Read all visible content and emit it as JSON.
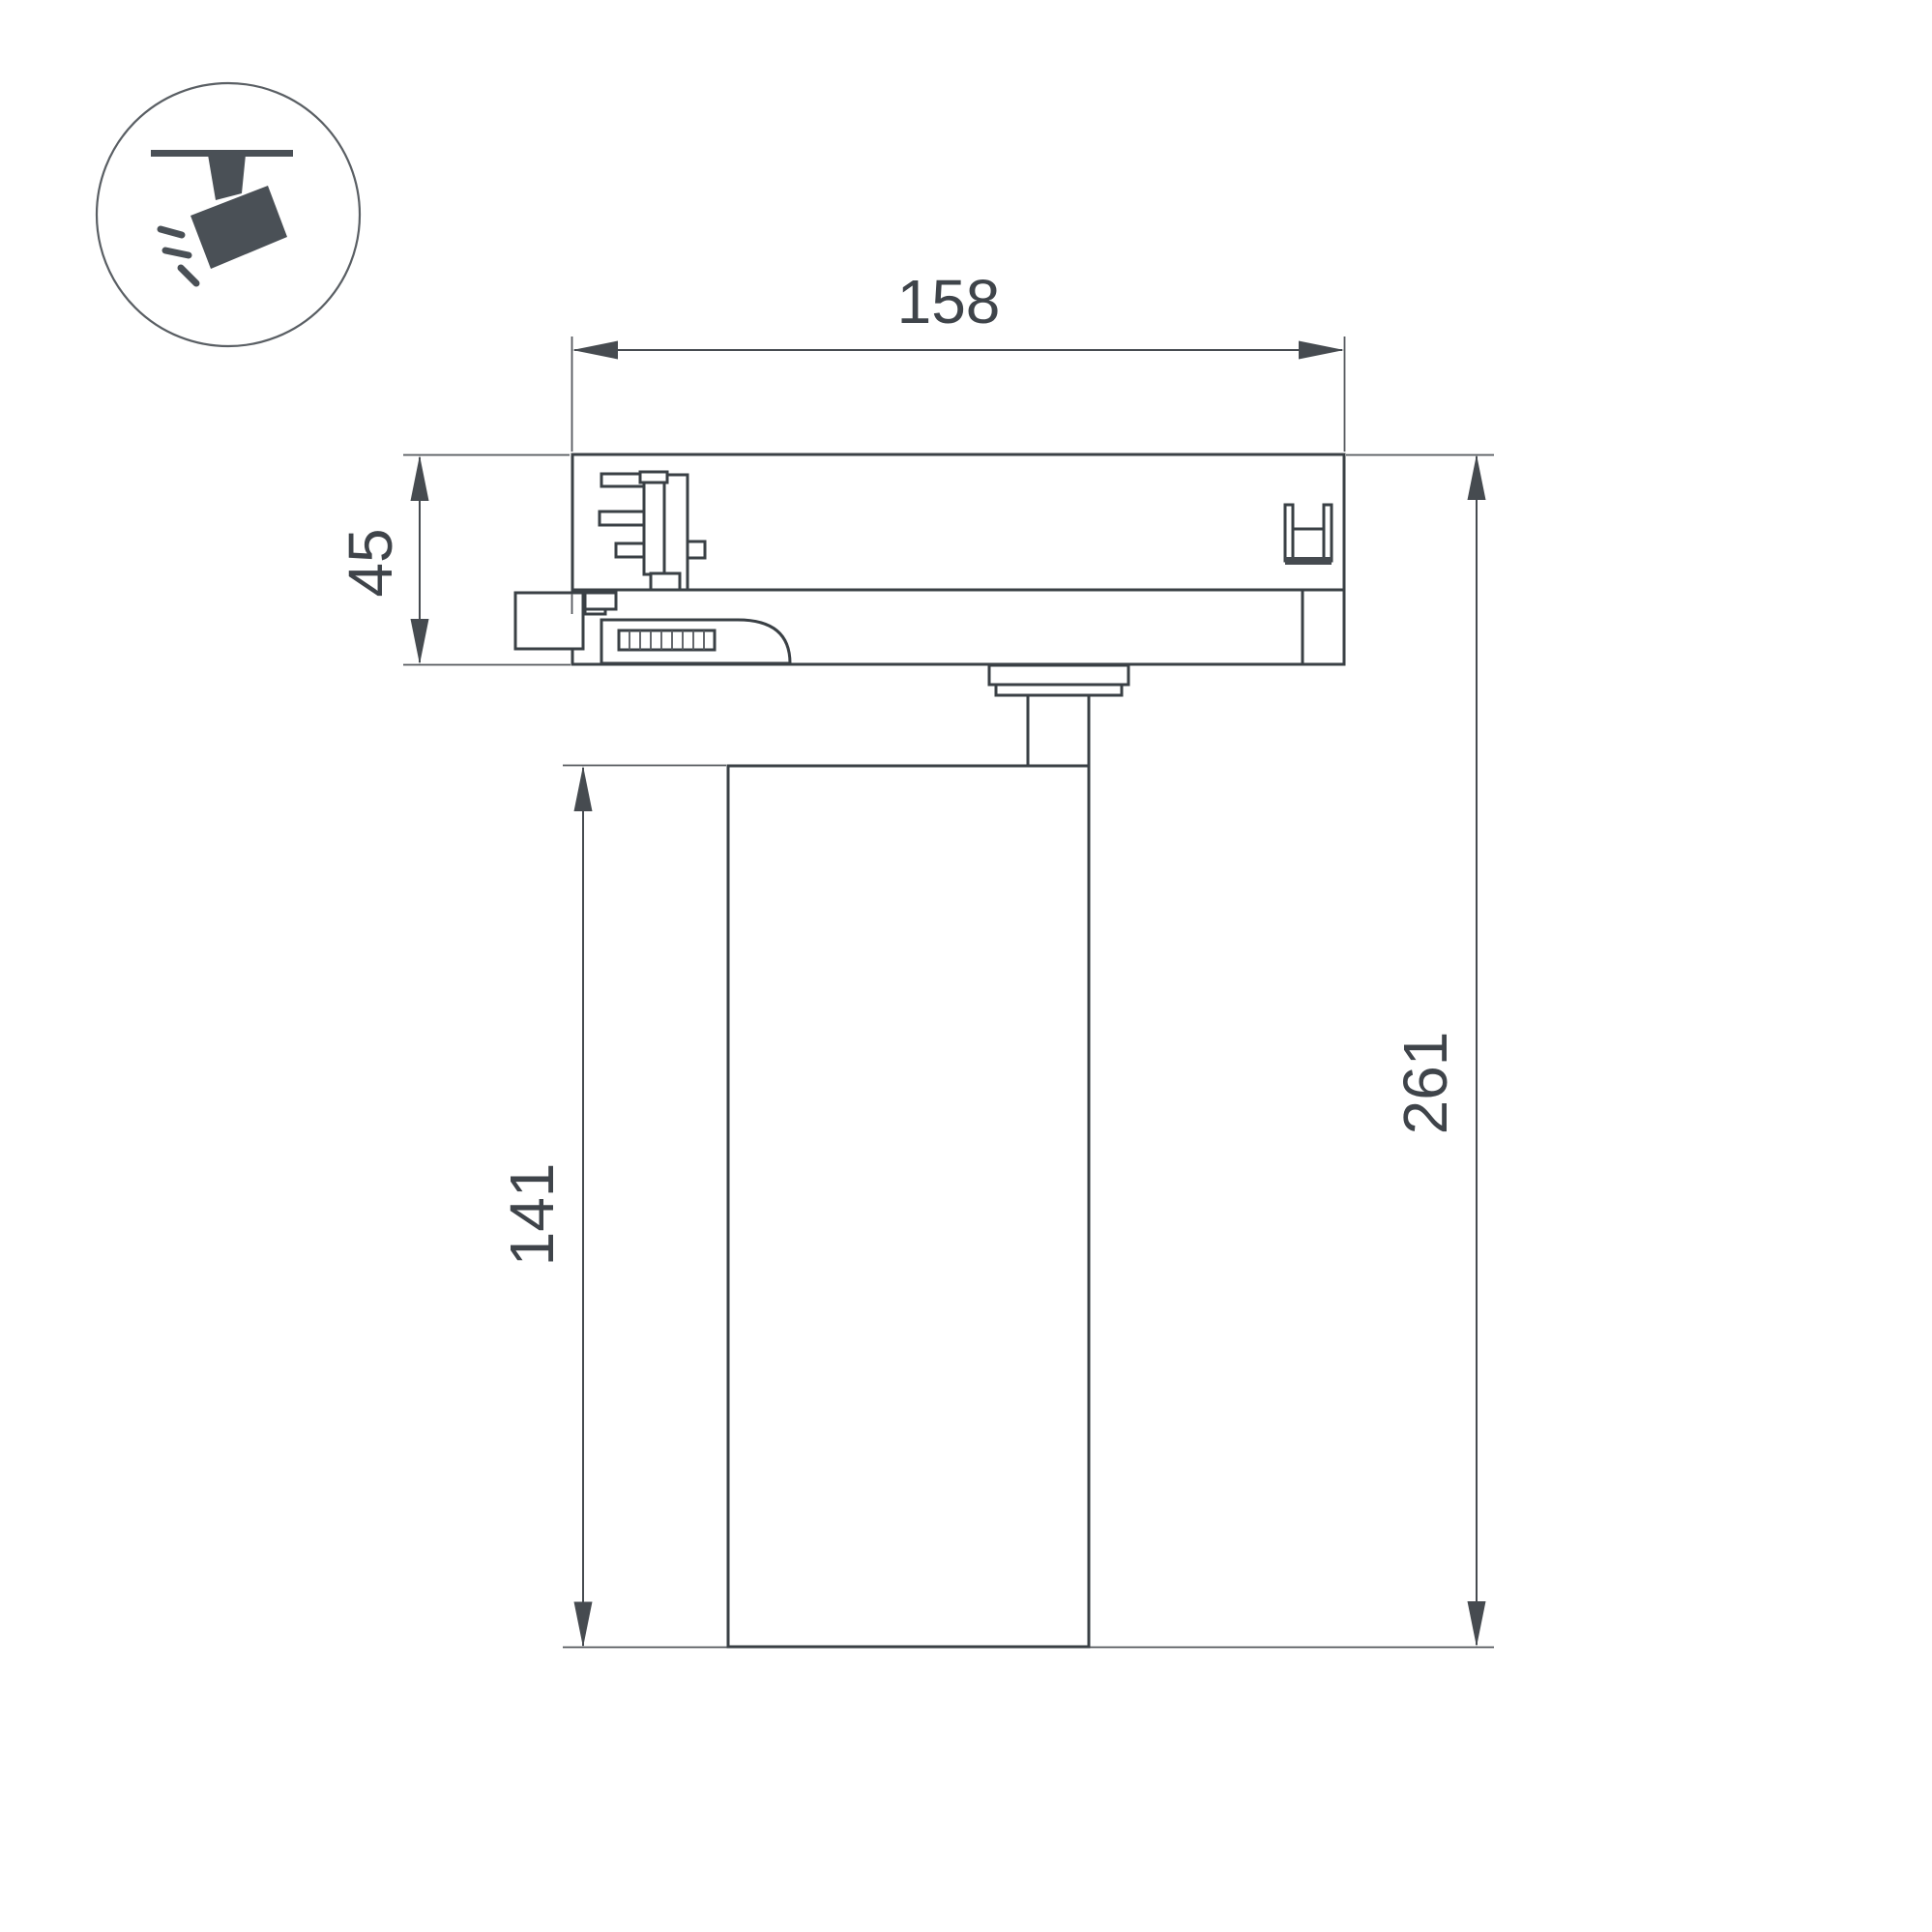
{
  "title": "Track spotlight dimension drawing",
  "icon": {
    "label": "track-spotlight-pictogram"
  },
  "dims": {
    "width": "158",
    "adapter_height": "45",
    "body_height": "141",
    "total_height": "261",
    "diameter": "Ø90"
  },
  "colors": {
    "background": "#ffffff",
    "outline": "#3a4045",
    "dimension": "#464b50",
    "thin_line": "#55595e",
    "text": "#3f444a",
    "icon": "#4a5056"
  }
}
